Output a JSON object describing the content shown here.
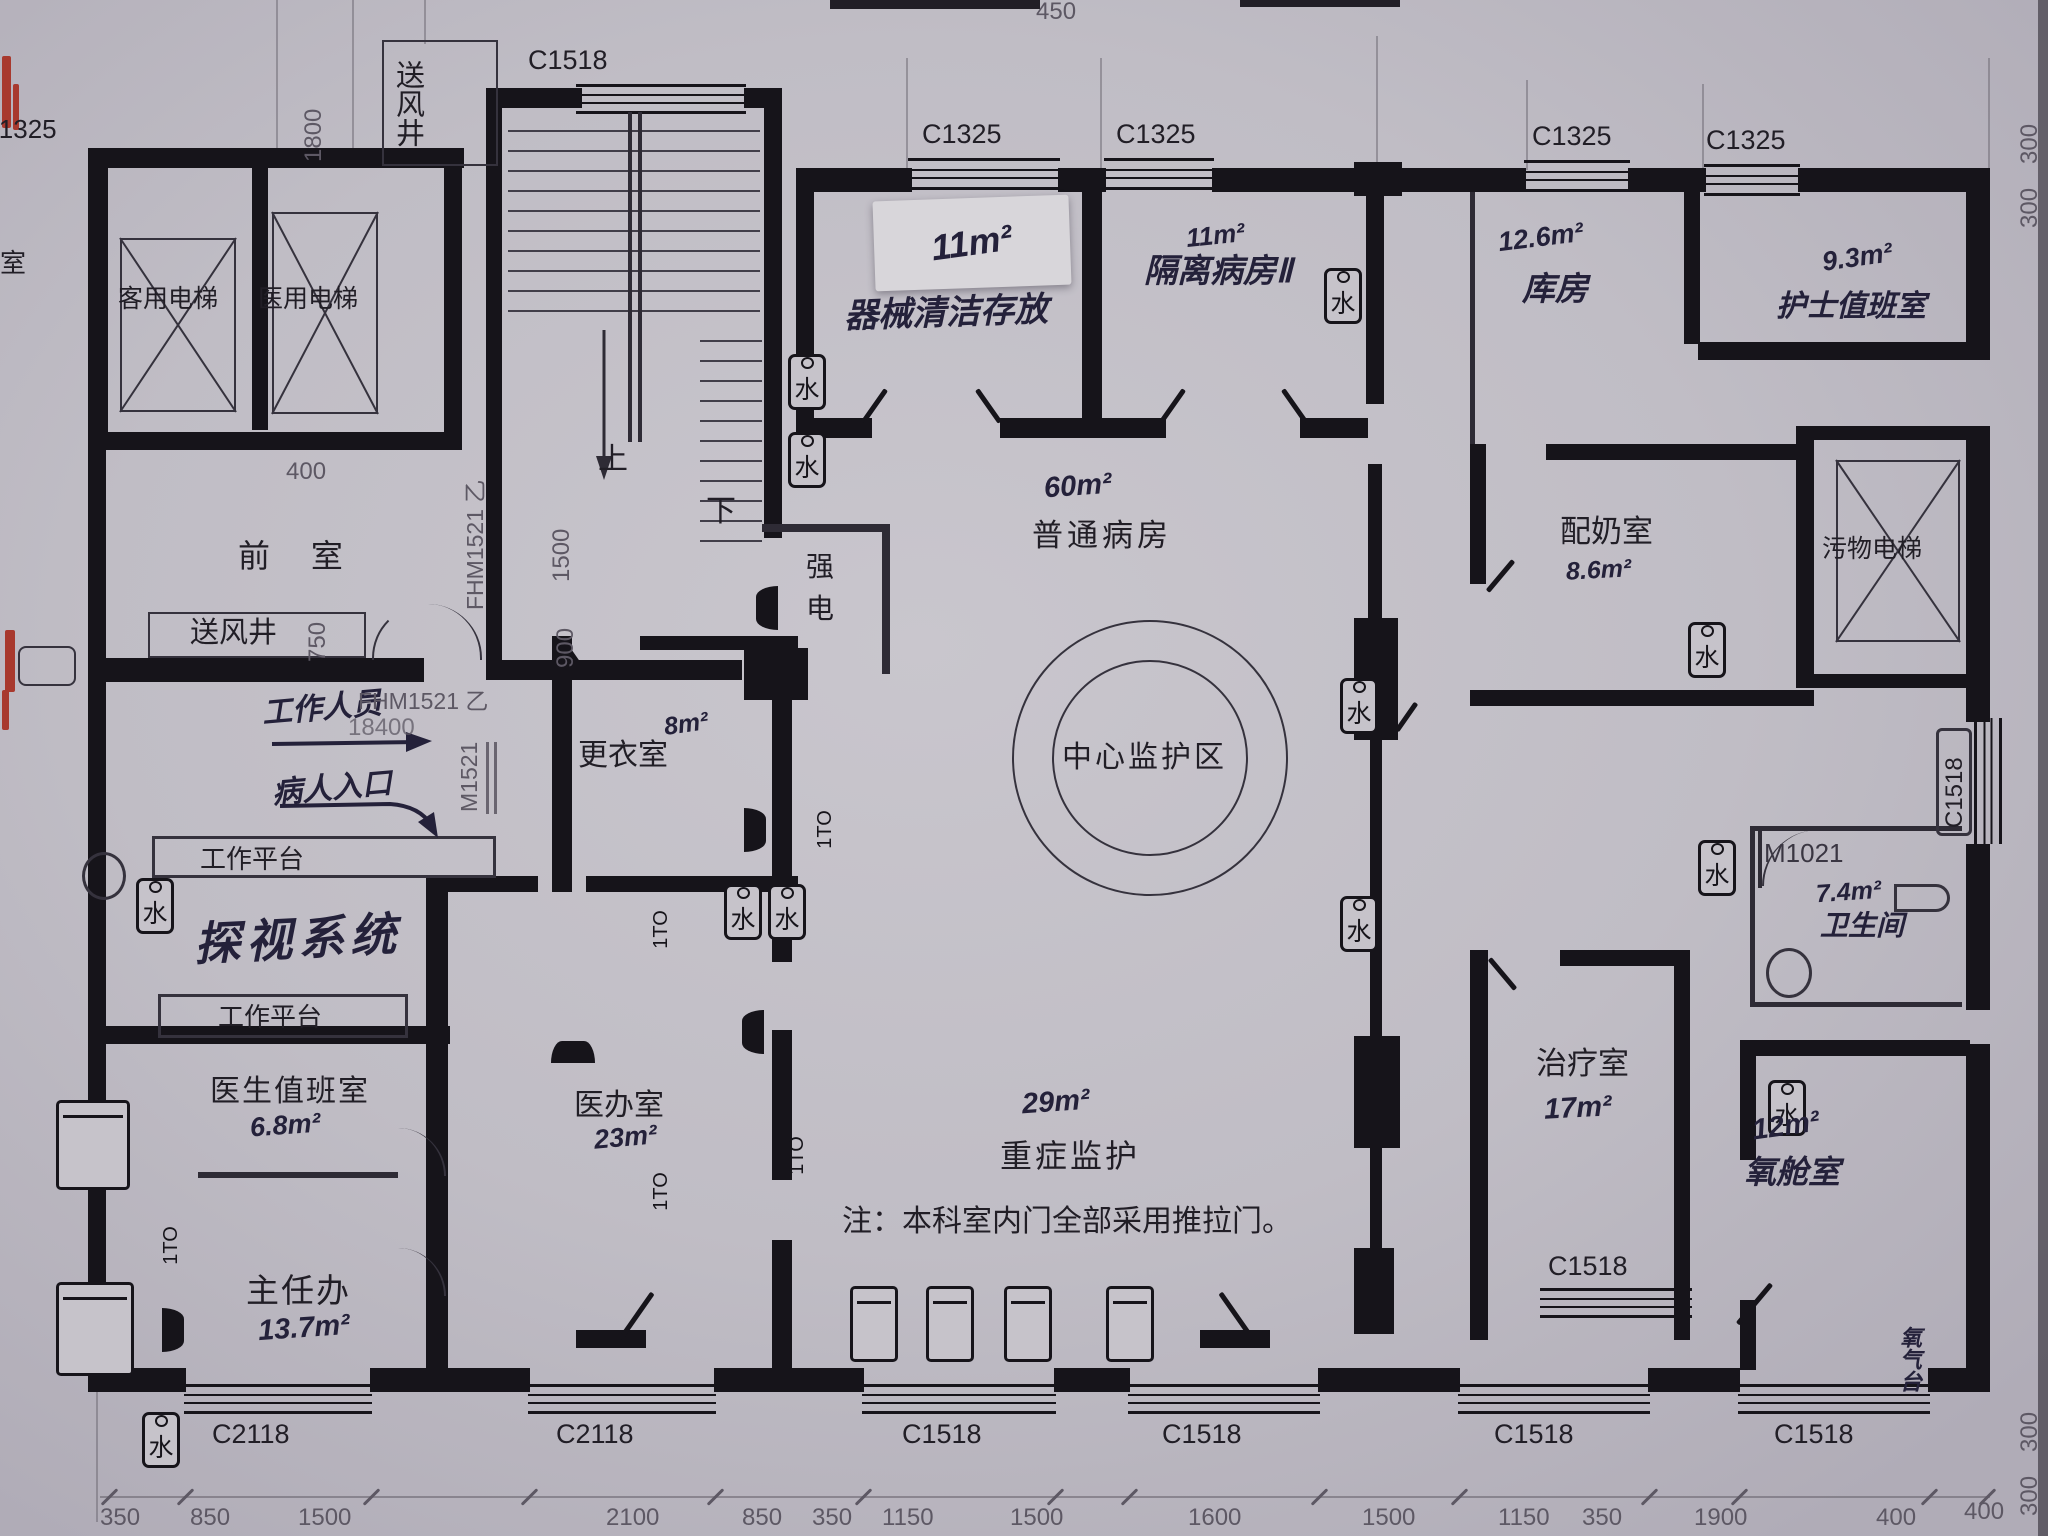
{
  "plan_title": "ICU hospital ward floor plan (photographed blueprint)",
  "rooms": {
    "passenger_elevator": {
      "name": "客用电梯"
    },
    "medical_elevator": {
      "name": "医用电梯"
    },
    "air_shaft": {
      "name": "送风井"
    },
    "anteroom": {
      "name": "前  室"
    },
    "strong_electric": {
      "name": "强电"
    },
    "equip_clean": {
      "name": "器械清洁存放",
      "area": "11m²"
    },
    "isolation_ward": {
      "name": "隔离病房Ⅱ",
      "area": "11m²"
    },
    "storeroom": {
      "name": "库房",
      "area": "12.6m²"
    },
    "nurse_duty": {
      "name": "护士值班室",
      "area": "9.3m²"
    },
    "general_ward": {
      "name": "普通病房",
      "area": "60m²"
    },
    "milk_prep": {
      "name": "配奶室",
      "area": "8.6m²"
    },
    "waste_elevator": {
      "name": "污物电梯"
    },
    "central_monitor": {
      "name": "中心监护区"
    },
    "changing_room": {
      "name": "更衣室",
      "area": "8m²"
    },
    "doctor_office": {
      "name": "医办室",
      "area": "23m²"
    },
    "icu_ward": {
      "name": "重症监护",
      "area": "29m²"
    },
    "treatment_room": {
      "name": "治疗室",
      "area": "17m²"
    },
    "oxygen_chamber": {
      "name": "氧舱室",
      "area": "12m²"
    },
    "bathroom": {
      "name": "卫生间",
      "area": "7.4m²"
    },
    "doctor_duty": {
      "name": "医生值班室",
      "area": "6.8m²"
    },
    "director_office": {
      "name": "主任办",
      "area": "13.7m²"
    },
    "visit_system": {
      "name": "探视系统"
    },
    "work_platform": {
      "name": "工作平台"
    }
  },
  "annotations": {
    "note": "注：本科室内门全部采用推拉门。",
    "staff_entry": "工作人员",
    "patient_entry": "病人入口",
    "stairs_up": "上",
    "stairs_down": "下",
    "oxygen_stand": "氧气台",
    "left_edge_room": "室"
  },
  "tags": {
    "c1518": "C1518",
    "c1325": "C1325",
    "c2118": "C2118",
    "fhm1521": "FHM1521 乙",
    "m1521": "M1521",
    "m1021": "M1021",
    "detail_1to": "1TO",
    "water": "水"
  },
  "dimensions": {
    "d1800": "1800",
    "d400": "400",
    "d750": "750",
    "d1500": "1500",
    "d900": "900",
    "d18400": "18400",
    "d450": "450",
    "d300": "300",
    "d400r": "400",
    "bottom_row": [
      "350",
      "850",
      "1500",
      "2100",
      "850",
      "350",
      "1150",
      "1500",
      "1600",
      "1500",
      "1150",
      "350",
      "1900",
      "400"
    ]
  },
  "colors": {
    "paper": "#c0bdc5",
    "wall": "#16141a",
    "dim_text": "#5d5864",
    "ink": "#24213a",
    "red_mark": "#a8392e"
  }
}
